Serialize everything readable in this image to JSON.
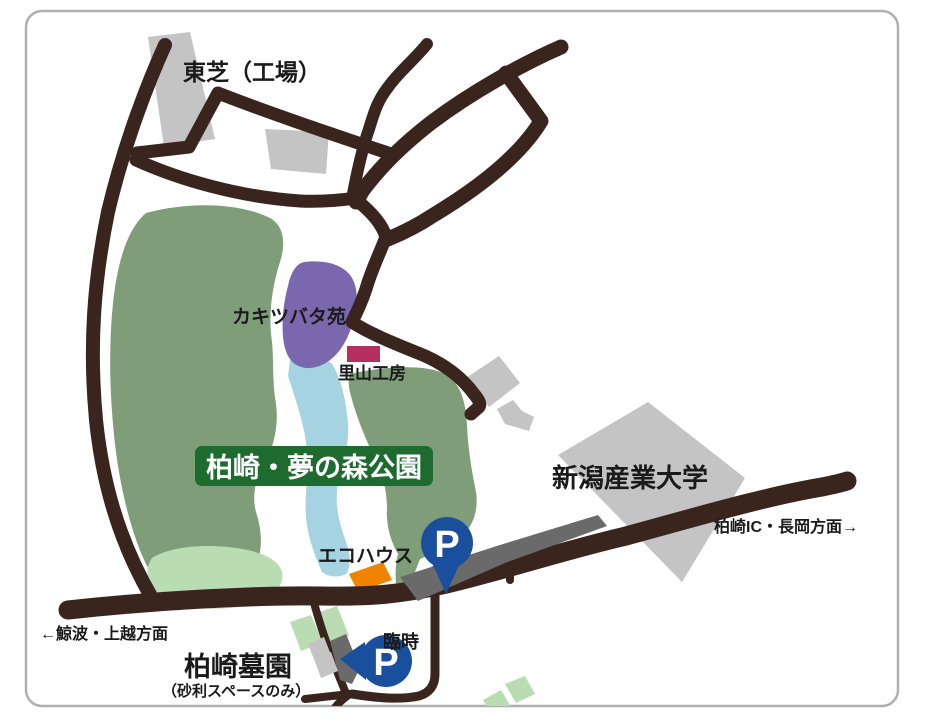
{
  "map": {
    "name": "柏崎・夢の森公園 アクセスマップ",
    "banner": {
      "title": "柏崎・夢の森公園"
    },
    "labels": {
      "toshiba": "東芝（工場）",
      "kakitsubata": "カキツバタ苑",
      "satoyama": "里山工房",
      "university": "新潟産業大学",
      "ic_direction": "柏崎IC・長岡方面→",
      "ecohouse": "エコハウス",
      "route73": "県道73号線",
      "kujiranami_direction": "←鯨波・上越方面",
      "temporary": "臨時",
      "cemetery": "柏崎墓園",
      "cemetery_note": "（砂利スペースのみ）",
      "parking_letter": "P"
    },
    "colors": {
      "road": "#3a241e",
      "park_green": "#7e9d78",
      "light_green": "#b9dcb2",
      "water_blue": "#a5d3e2",
      "garden_purple": "#7a68ae",
      "workshop_red": "#b5305f",
      "ecohouse_orange": "#f08300",
      "building_gray": "#c4c4c4",
      "parking_lot_gray": "#6a6a6a",
      "banner_green": "#1e6b30",
      "parking_pin_blue": "#1a4f9e",
      "border_gray": "#b0b0b0"
    }
  }
}
